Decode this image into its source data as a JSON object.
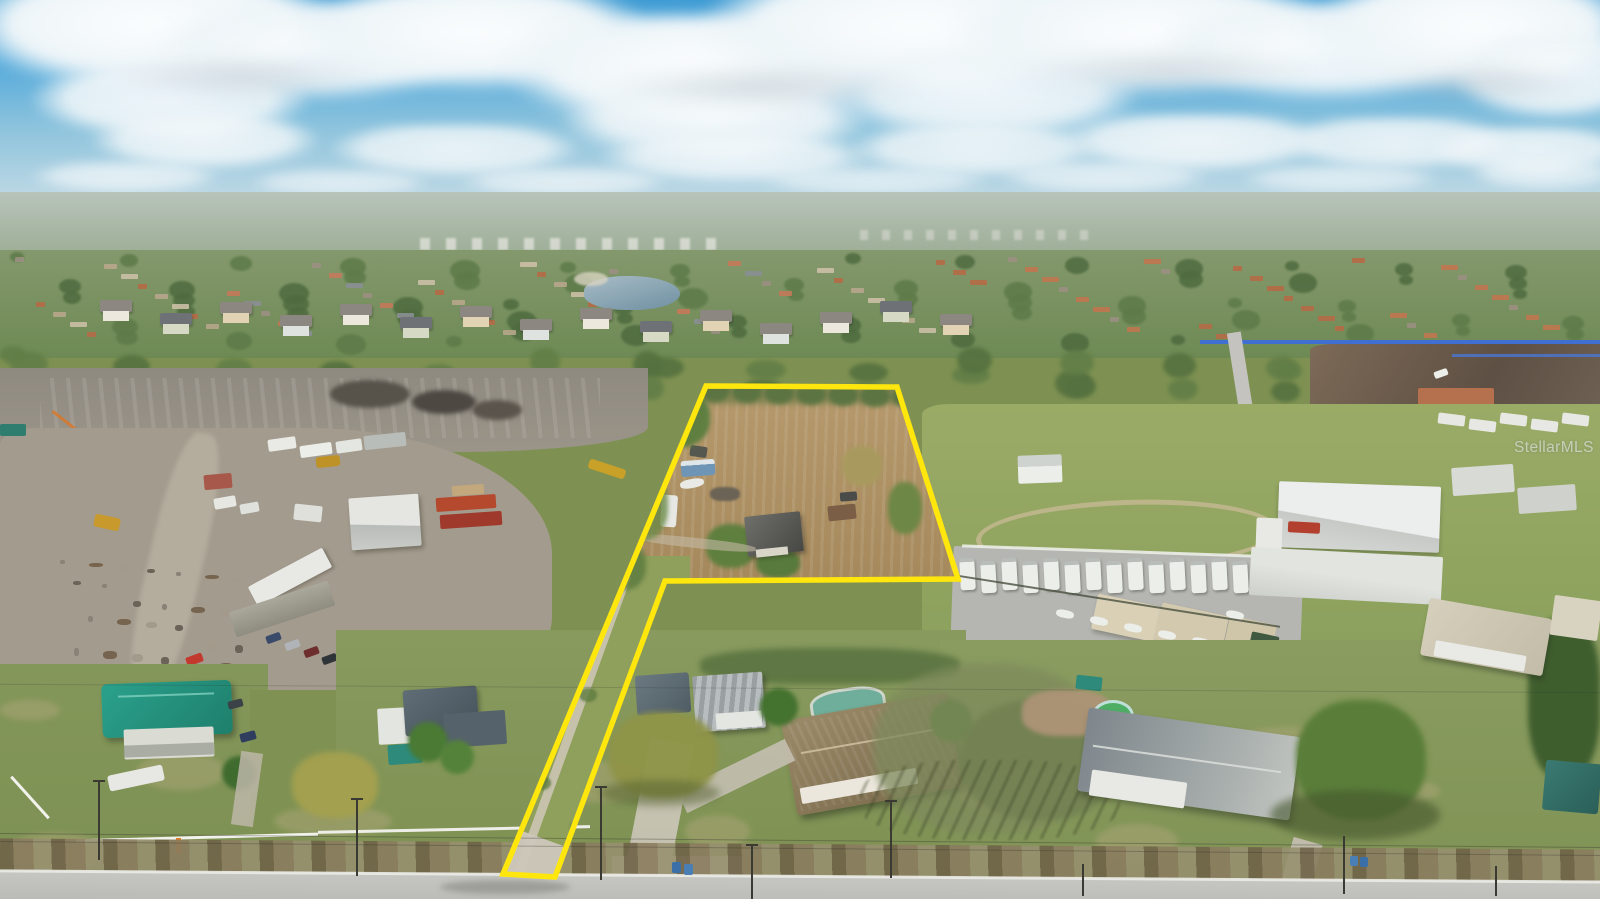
{
  "image": {
    "type": "aerial-drone-photograph",
    "description": "Aerial real-estate photo of a flag-shaped vacant acreage parcel outlined in yellow, with a small shed, bus and RV on the cleared tan field. Surroundings: industrial salvage yard and cleared dirt at left, RV and boat storage facility with white warehouses at right, single-family homes with pools along a two-lane road in the foreground, and a large suburban subdivision with a pond stretching to the horizon under a blue sky with cumulus clouds.",
    "watermark": "StellarMLS"
  },
  "property_boundary": {
    "shape": "flag-lot-polygon",
    "stroke_width": 5.5,
    "points": [
      [
        706,
        386
      ],
      [
        897,
        387
      ],
      [
        958,
        579
      ],
      [
        665,
        581
      ],
      [
        555,
        877
      ],
      [
        503,
        874
      ]
    ]
  },
  "colors": {
    "boundary_yellow": "#ffe70d",
    "sky_top": "#3f9cd4",
    "sky_horizon": "#c6dce6",
    "cloud_white": "#fbfdfe",
    "parcel_field_tan": "#b0956a",
    "suburb_green": "#6e8a54",
    "road_asphalt": "#b8b8b4",
    "teal_roof": "#2aa18c",
    "container_red": "#b5492e",
    "pond_blue": "#6f90a2",
    "watermark_text": "rgba(255,255,255,0.52)"
  }
}
